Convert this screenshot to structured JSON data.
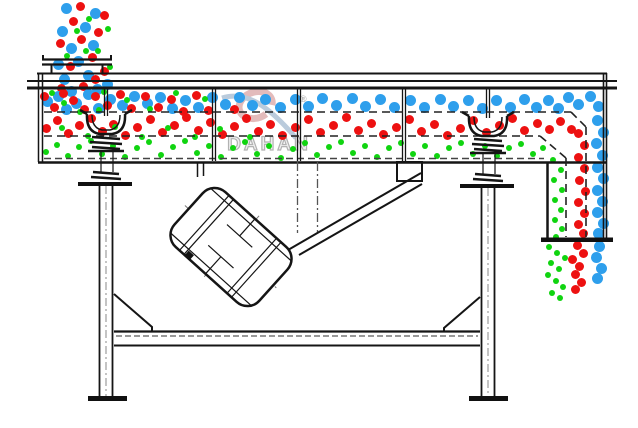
{
  "diagram": {
    "watermark": {
      "brand": "DAHAN",
      "registered": "®"
    },
    "colors": {
      "coarse_particle_blue": "#2E9FEC",
      "medium_particle_red": "#ED1111",
      "fine_particle_green": "#10D410",
      "line_black": "#151515",
      "watermark_gray": "#9f9f9f",
      "watermark_red": "#ddabab",
      "watermark_blue": "#a9bfd4"
    }
  },
  "particles": {
    "groups": [
      {
        "name": "feed-stream-blue",
        "color": "#2E9FEC",
        "size": 11,
        "points": [
          [
            66,
            8
          ],
          [
            95,
            13
          ],
          [
            62,
            31
          ],
          [
            85,
            27
          ],
          [
            71,
            48
          ],
          [
            93,
            45
          ],
          [
            58,
            64
          ],
          [
            78,
            61
          ],
          [
            64,
            79
          ],
          [
            88,
            75
          ],
          [
            71,
            91
          ],
          [
            97,
            89
          ],
          [
            107,
            84
          ]
        ]
      },
      {
        "name": "feed-stream-red",
        "color": "#ED1111",
        "size": 9,
        "points": [
          [
            80,
            6
          ],
          [
            104,
            15
          ],
          [
            73,
            21
          ],
          [
            98,
            32
          ],
          [
            60,
            43
          ],
          [
            81,
            39
          ],
          [
            92,
            57
          ],
          [
            70,
            66
          ],
          [
            104,
            71
          ],
          [
            61,
            88
          ],
          [
            83,
            86
          ],
          [
            95,
            79
          ]
        ]
      },
      {
        "name": "feed-stream-green",
        "color": "#10D410",
        "size": 6,
        "points": [
          [
            89,
            19
          ],
          [
            108,
            29
          ],
          [
            77,
            31
          ],
          [
            98,
            51
          ],
          [
            110,
            67
          ],
          [
            67,
            56
          ],
          [
            86,
            51
          ],
          [
            104,
            92
          ]
        ]
      },
      {
        "name": "top-deck-blue",
        "color": "#2E9FEC",
        "size": 11,
        "points": [
          [
            47,
            101
          ],
          [
            58,
            96
          ],
          [
            66,
            109
          ],
          [
            76,
            103
          ],
          [
            88,
            94
          ],
          [
            98,
            108
          ],
          [
            110,
            99
          ],
          [
            122,
            105
          ],
          [
            134,
            96
          ],
          [
            147,
            103
          ],
          [
            160,
            97
          ],
          [
            172,
            108
          ],
          [
            185,
            100
          ],
          [
            198,
            107
          ],
          [
            212,
            97
          ],
          [
            225,
            104
          ],
          [
            239,
            97
          ],
          [
            252,
            105
          ],
          [
            265,
            99
          ],
          [
            280,
            107
          ],
          [
            295,
            99
          ],
          [
            308,
            106
          ],
          [
            322,
            98
          ],
          [
            336,
            105
          ],
          [
            352,
            98
          ],
          [
            365,
            106
          ],
          [
            380,
            99
          ],
          [
            394,
            107
          ],
          [
            410,
            100
          ],
          [
            424,
            107
          ],
          [
            440,
            99
          ],
          [
            453,
            106
          ],
          [
            468,
            100
          ],
          [
            482,
            108
          ],
          [
            496,
            100
          ],
          [
            510,
            107
          ],
          [
            524,
            99
          ],
          [
            536,
            107
          ],
          [
            548,
            100
          ],
          [
            558,
            108
          ],
          [
            568,
            97
          ],
          [
            578,
            104
          ],
          [
            590,
            96
          ],
          [
            598,
            106
          ]
        ]
      },
      {
        "name": "top-deck-red",
        "color": "#ED1111",
        "size": 9,
        "points": [
          [
            44,
            96
          ],
          [
            54,
            107
          ],
          [
            63,
            93
          ],
          [
            73,
            100
          ],
          [
            84,
            109
          ],
          [
            95,
            96
          ],
          [
            107,
            105
          ],
          [
            120,
            94
          ],
          [
            131,
            108
          ],
          [
            145,
            96
          ],
          [
            158,
            107
          ],
          [
            171,
            99
          ],
          [
            183,
            111
          ],
          [
            196,
            95
          ],
          [
            208,
            110
          ],
          [
            234,
            109
          ]
        ]
      },
      {
        "name": "top-deck-green",
        "color": "#10D410",
        "size": 6,
        "points": [
          [
            52,
            93
          ],
          [
            64,
            103
          ],
          [
            80,
            112
          ],
          [
            99,
            110
          ],
          [
            127,
            100
          ],
          [
            150,
            109
          ],
          [
            176,
            93
          ],
          [
            205,
            99
          ]
        ]
      },
      {
        "name": "middle-deck-red",
        "color": "#ED1111",
        "size": 9,
        "points": [
          [
            46,
            128
          ],
          [
            57,
            120
          ],
          [
            68,
            133
          ],
          [
            79,
            125
          ],
          [
            91,
            118
          ],
          [
            102,
            131
          ],
          [
            113,
            124
          ],
          [
            125,
            135
          ],
          [
            137,
            127
          ],
          [
            150,
            119
          ],
          [
            162,
            132
          ],
          [
            174,
            125
          ],
          [
            186,
            117
          ],
          [
            198,
            130
          ],
          [
            210,
            122
          ],
          [
            222,
            134
          ],
          [
            234,
            126
          ],
          [
            246,
            118
          ],
          [
            258,
            131
          ],
          [
            270,
            124
          ],
          [
            282,
            135
          ],
          [
            295,
            127
          ],
          [
            308,
            119
          ],
          [
            320,
            132
          ],
          [
            333,
            125
          ],
          [
            346,
            117
          ],
          [
            358,
            130
          ],
          [
            371,
            123
          ],
          [
            383,
            134
          ],
          [
            396,
            127
          ],
          [
            409,
            119
          ],
          [
            421,
            131
          ],
          [
            434,
            124
          ],
          [
            447,
            135
          ],
          [
            460,
            128
          ],
          [
            473,
            120
          ],
          [
            486,
            132
          ],
          [
            499,
            125
          ],
          [
            512,
            118
          ],
          [
            524,
            130
          ],
          [
            537,
            123
          ],
          [
            549,
            129
          ],
          [
            560,
            121
          ],
          [
            571,
            129
          ]
        ]
      },
      {
        "name": "middle-deck-green",
        "color": "#10D410",
        "size": 6,
        "points": [
          [
            62,
            128
          ],
          [
            88,
            136
          ],
          [
            115,
            127
          ],
          [
            142,
            137
          ],
          [
            168,
            128
          ],
          [
            195,
            137
          ],
          [
            220,
            129
          ],
          [
            250,
            137
          ]
        ]
      },
      {
        "name": "bottom-pan-green",
        "color": "#10D410",
        "size": 6,
        "points": [
          [
            46,
            152
          ],
          [
            57,
            145
          ],
          [
            68,
            156
          ],
          [
            79,
            147
          ],
          [
            91,
            141
          ],
          [
            102,
            154
          ],
          [
            113,
            146
          ],
          [
            125,
            157
          ],
          [
            137,
            148
          ],
          [
            149,
            142
          ],
          [
            161,
            155
          ],
          [
            173,
            147
          ],
          [
            185,
            141
          ],
          [
            197,
            153
          ],
          [
            209,
            146
          ],
          [
            221,
            157
          ],
          [
            233,
            148
          ],
          [
            245,
            142
          ],
          [
            257,
            154
          ],
          [
            269,
            146
          ],
          [
            281,
            158
          ],
          [
            293,
            149
          ],
          [
            305,
            143
          ],
          [
            317,
            155
          ],
          [
            329,
            147
          ],
          [
            341,
            142
          ],
          [
            353,
            153
          ],
          [
            365,
            146
          ],
          [
            377,
            157
          ],
          [
            389,
            148
          ],
          [
            401,
            143
          ],
          [
            413,
            154
          ],
          [
            425,
            146
          ],
          [
            437,
            156
          ],
          [
            449,
            148
          ],
          [
            461,
            143
          ],
          [
            473,
            154
          ],
          [
            485,
            146
          ],
          [
            497,
            156
          ],
          [
            509,
            148
          ],
          [
            521,
            144
          ],
          [
            533,
            154
          ],
          [
            543,
            148
          ]
        ]
      },
      {
        "name": "discharge-blue",
        "color": "#2E9FEC",
        "size": 11,
        "points": [
          [
            597,
            120
          ],
          [
            603,
            132
          ],
          [
            596,
            143
          ],
          [
            602,
            155
          ],
          [
            597,
            167
          ],
          [
            603,
            178
          ],
          [
            597,
            190
          ],
          [
            602,
            201
          ],
          [
            597,
            212
          ],
          [
            603,
            223
          ],
          [
            598,
            233
          ],
          [
            599,
            246
          ],
          [
            596,
            257
          ],
          [
            601,
            268
          ],
          [
            597,
            278
          ]
        ]
      },
      {
        "name": "discharge-red",
        "color": "#ED1111",
        "size": 9,
        "points": [
          [
            578,
            133
          ],
          [
            584,
            145
          ],
          [
            578,
            157
          ],
          [
            584,
            168
          ],
          [
            579,
            180
          ],
          [
            585,
            191
          ],
          [
            578,
            202
          ],
          [
            584,
            213
          ],
          [
            578,
            224
          ],
          [
            583,
            233
          ],
          [
            577,
            245
          ],
          [
            583,
            253
          ],
          [
            572,
            259
          ],
          [
            579,
            266
          ],
          [
            575,
            274
          ],
          [
            581,
            282
          ],
          [
            575,
            289
          ]
        ]
      },
      {
        "name": "discharge-green",
        "color": "#10D410",
        "size": 6,
        "points": [
          [
            553,
            160
          ],
          [
            561,
            170
          ],
          [
            554,
            180
          ],
          [
            562,
            190
          ],
          [
            555,
            200
          ],
          [
            561,
            210
          ],
          [
            555,
            220
          ],
          [
            562,
            229
          ],
          [
            556,
            237
          ],
          [
            549,
            247
          ],
          [
            557,
            253
          ],
          [
            565,
            258
          ],
          [
            551,
            263
          ],
          [
            559,
            269
          ],
          [
            548,
            275
          ],
          [
            556,
            281
          ],
          [
            563,
            287
          ],
          [
            552,
            293
          ],
          [
            560,
            298
          ]
        ]
      }
    ]
  }
}
